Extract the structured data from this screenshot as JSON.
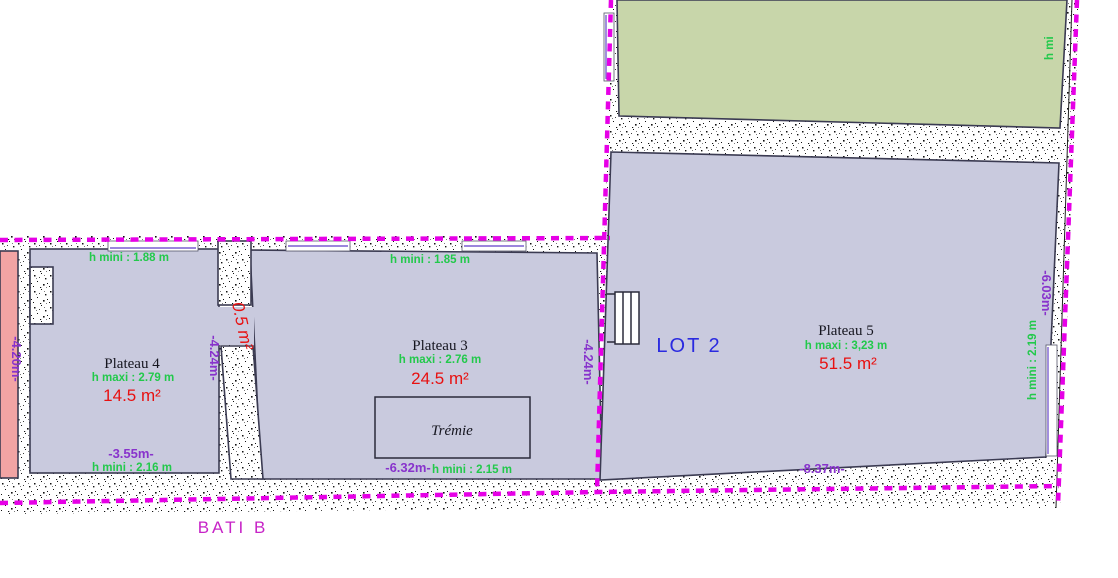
{
  "labels": {
    "bati_b": "BATI B",
    "lot_2": "LOT 2"
  },
  "plateau4": {
    "name": "Plateau 4",
    "h_maxi": "h maxi : 2.79 m",
    "area": "14.5 m²",
    "h_mini_top": "h mini : 1.88 m",
    "width_dim": "-3.55m-",
    "h_mini_bottom": "h mini : 2.16 m",
    "height_dim_left": "-4.20m-"
  },
  "plateau3": {
    "name": "Plateau 3",
    "h_maxi": "h maxi : 2.76 m",
    "area": "24.5 m²",
    "h_mini_top": "h mini : 1.85 m",
    "width_dim": "-6.32m-",
    "h_mini_bottom": "h mini : 2.15 m",
    "tremie": "Trémie"
  },
  "plateau5": {
    "name": "Plateau 5",
    "h_maxi": "h maxi : 3,23 m",
    "area": "51.5 m²",
    "width_dim": "-8.37m-",
    "height_dim_right": "-6.03m-",
    "h_mini_right": "h mini : 2.19 m",
    "lot_height_dim": "-4.24m-"
  },
  "separating_wall": {
    "area": "0.5 m²",
    "height_dim": "-4.24m-"
  },
  "green_room": {
    "h_mini_cut": "h mi"
  },
  "colors": {
    "floor_lavender": "#c9cade",
    "floor_pink": "#f2a4a4",
    "floor_green": "#c8d6aa",
    "boundary_magenta": "#e600e6",
    "dim_purple": "#8833cc",
    "height_green": "#22c94b",
    "area_red": "#e81010",
    "lot_blue": "#2a2ae0",
    "outline_dark": "#3b3b52",
    "bati_label_magenta": "#c723c7"
  }
}
